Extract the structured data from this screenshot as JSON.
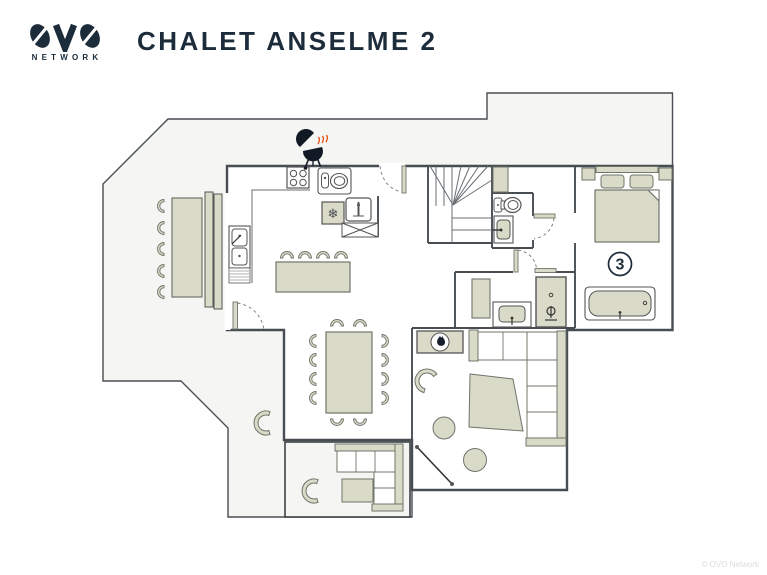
{
  "header": {
    "brand": "OVO",
    "brand_sub": "NETWORK",
    "title": "CHALET ANSELME 2"
  },
  "plan": {
    "room_number": "3",
    "snowflake_glyph": "❄",
    "colors": {
      "navy": "#1d2c3b",
      "wall": "#474d52",
      "furniture_fill": "#d9dac8",
      "furniture_outline": "#70756a",
      "terrace_fill": "#f5f5f3",
      "flame_red": "#e8470e"
    },
    "icons": [
      "bbq-icon",
      "fireplace-flame-icon",
      "snowflake-icon",
      "shower-head-icon"
    ]
  },
  "footer": {
    "copyright": "© OVO Network"
  }
}
